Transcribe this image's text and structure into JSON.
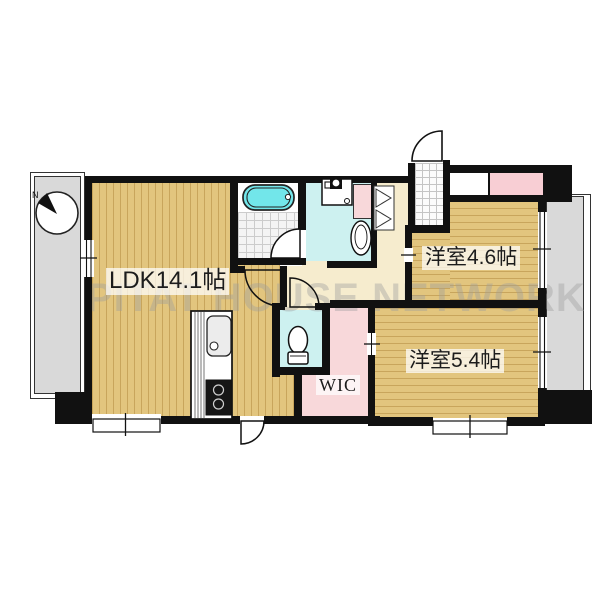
{
  "floorplan": {
    "title": "2LDK apartment floor plan",
    "watermark": {
      "text": "PITAT HOUSE NETWORK"
    },
    "compass": {
      "label": "N"
    },
    "labels": {
      "ldk": "LDK14.1帖",
      "bedroom1": "洋室4.6帖",
      "bedroom2": "洋室5.4帖",
      "wic": "WIC"
    },
    "colors": {
      "wall": "#111111",
      "wood_floor_base": "#e2c57e",
      "wood_floor_stripe": "#c8a55c",
      "hallway": "#f6ecce",
      "wet_room_cyan": "#cdf1f0",
      "closet_pink": "#f8d8da",
      "bathtub_cyan": "#72e6ea",
      "balcony_gray": "#d9d9d9",
      "watermark_gray": "#9e9e9e"
    },
    "fixtures": [
      "bathtub",
      "bathroom-tile-floor",
      "washing-machine-pan",
      "washbasin",
      "toilet",
      "kitchen-counter",
      "kitchen-sink",
      "stove",
      "hall-closet-doors",
      "entrance-door",
      "compass"
    ]
  }
}
